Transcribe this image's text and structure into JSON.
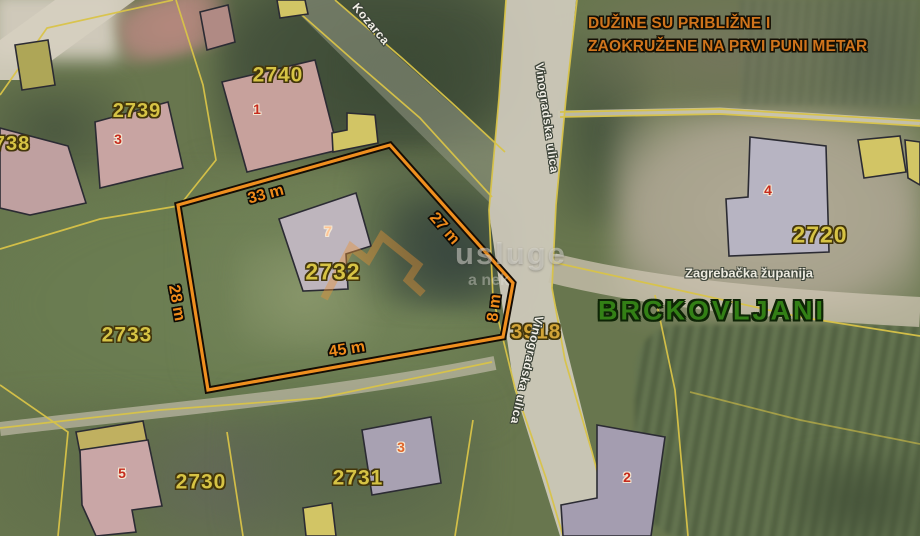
{
  "map": {
    "disclaimer": {
      "line1": "DUŽINE SU PRIBLIŽNE I",
      "line2": "ZAOKRUŽENE NA PRVI PUNI METAR"
    },
    "place": "BRCKOVLJANI",
    "county": "Zagrebačka županija",
    "watermark": {
      "large": "usluge",
      "small": "a nek"
    },
    "colors": {
      "highlight_outline": "#ef8f1f",
      "cadastral_line": "#d9c348",
      "parcel_number": "#d6c344",
      "building_number": "#c62b1d",
      "dimension_text": "#ef8a1a",
      "place_text": "#338016",
      "disclaimer_text": "#d0741c",
      "street_text": "#f2efe7"
    },
    "highlight_parcel": {
      "number": "2732",
      "dimensions": [
        {
          "t": "33 m",
          "x": 266,
          "y": 195,
          "r": -15
        },
        {
          "t": "27 m",
          "x": 444,
          "y": 229,
          "r": 49
        },
        {
          "t": "8 m",
          "x": 495,
          "y": 308,
          "r": -83
        },
        {
          "t": "45 m",
          "x": 347,
          "y": 350,
          "r": -9
        },
        {
          "t": "28 m",
          "x": 176,
          "y": 303,
          "r": 80
        }
      ]
    },
    "parcel_numbers": [
      {
        "t": "2740",
        "x": 278,
        "y": 75,
        "s": 21
      },
      {
        "t": "2739",
        "x": 137,
        "y": 111,
        "s": 20
      },
      {
        "t": "2738",
        "x": 6,
        "y": 144,
        "s": 20
      },
      {
        "t": "2732",
        "x": 333,
        "y": 272,
        "s": 23
      },
      {
        "t": "2733",
        "x": 127,
        "y": 335,
        "s": 21
      },
      {
        "t": "2730",
        "x": 201,
        "y": 482,
        "s": 21
      },
      {
        "t": "2731",
        "x": 358,
        "y": 478,
        "s": 21
      },
      {
        "t": "2720",
        "x": 820,
        "y": 235,
        "s": 23
      },
      {
        "t": "3918",
        "x": 536,
        "y": 332,
        "s": 21,
        "c": "#d2a438"
      }
    ],
    "building_numbers": [
      {
        "t": "1",
        "x": 257,
        "y": 109
      },
      {
        "t": "3",
        "x": 118,
        "y": 139
      },
      {
        "t": "7",
        "x": 328,
        "y": 231,
        "c": "#ffc493"
      },
      {
        "t": "4",
        "x": 768,
        "y": 190
      },
      {
        "t": "5",
        "x": 122,
        "y": 473
      },
      {
        "t": "3",
        "x": 401,
        "y": 447,
        "c": "#e0662a"
      },
      {
        "t": "2",
        "x": 627,
        "y": 477
      }
    ],
    "streets": [
      {
        "t": "Kozarca",
        "x": 371,
        "y": 24,
        "r": 50
      },
      {
        "t": "Vinogradska ulica",
        "x": 547,
        "y": 118,
        "r": 82
      },
      {
        "t": "Vinogradska ulica",
        "x": 527,
        "y": 370,
        "r": 103
      }
    ]
  }
}
